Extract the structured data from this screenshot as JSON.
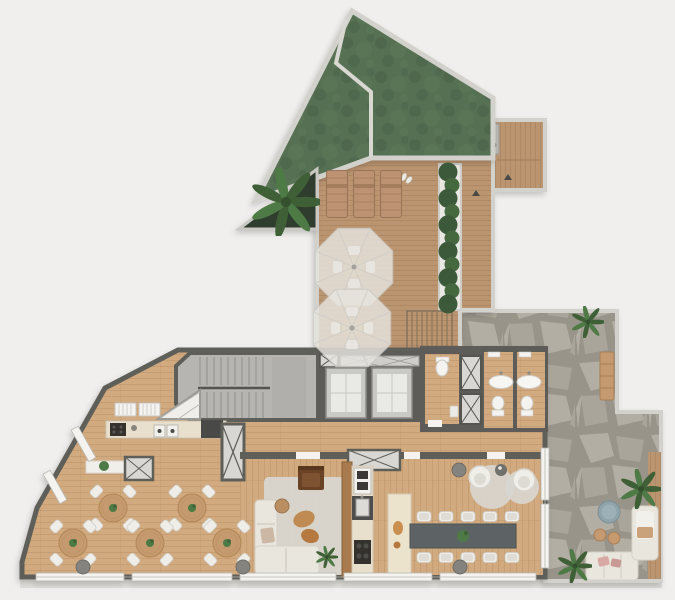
{
  "meta": {
    "name": "residential-rooftop-floor-plan",
    "description": "Top-down architectural floor plan rendering with green roof, sun deck, interior amenity floor and flagstone patio"
  },
  "colors": {
    "bg": "#f0efed",
    "wall_light": "#d2d1cc",
    "wall_mid": "#9a9a94",
    "wall_dark": "#5f5e5a",
    "roof_green": "#567052",
    "roof_green_dark": "#49614b",
    "roof_green_light": "#5e7a57",
    "planter_dark": "#2f3d2d",
    "deck": "#bb9570",
    "deck_line": "#a5805c",
    "floor": "#d2aa7f",
    "floor_line": "#bb9268",
    "stone_bg": "#98948a",
    "stone_fill": "#b2aea3",
    "stone_fill2": "#a9a59a",
    "stair": "#b6b5b1",
    "elevator_block": "#5d5c59",
    "cabin": "#c9c9c6",
    "counter": "#e8e0cd",
    "island": "#ece3cd",
    "hedge": "#3c5a39",
    "hedge2": "#46683f",
    "plant": "#4e7a46",
    "plant_dark": "#3f6036",
    "table_wood": "#c59a6f",
    "chair": "#efede8",
    "sofa": "#e9e6dd",
    "rug": "#d8d6d0",
    "armchair": "#6b4226",
    "coffee_table": "#c08b52",
    "long_table": "#5d6465",
    "partition": "#a97a4e",
    "umbrella": "#e7e5e0",
    "lounger": "#bc9273",
    "window": "#f4f3ef",
    "shaft": "#d8d7d3",
    "appliance_dark": "#34332f",
    "accent_pink": "#d8a9a4",
    "accent_blue": "#8fa3ab",
    "column": "#84837e"
  },
  "zones": {
    "green_roof": "green-roof",
    "roof_planter": "roof-planter-monstera",
    "sun_deck": "sun-deck",
    "lift_corridor": "accessible-lift-corridor",
    "hedge_planter": "hedge-planter",
    "deck_stairs": "deck-stairs",
    "stone_patio": "flagstone-patio",
    "stair_lobby": "stair-lobby",
    "elevators": "elevator-bank",
    "bathrooms": "bathrooms",
    "kitchen_west": "kitchen-west",
    "dining_area": "dining-area",
    "living_room": "living-room",
    "kitchen_east": "kitchen-east",
    "lounge_corner": "lounge-corner"
  },
  "furniture": {
    "loungers": [
      {
        "x": 326,
        "y": 170
      },
      {
        "x": 353,
        "y": 170
      },
      {
        "x": 380,
        "y": 170
      }
    ],
    "umbrellas": [
      {
        "cx": 354,
        "cy": 267
      },
      {
        "cx": 352,
        "cy": 328
      }
    ],
    "dining_tables": [
      {
        "cx": 113,
        "cy": 508
      },
      {
        "cx": 192,
        "cy": 508
      },
      {
        "cx": 73,
        "cy": 543
      },
      {
        "cx": 150,
        "cy": 543
      },
      {
        "cx": 227,
        "cy": 543
      }
    ],
    "long_table_chairs": {
      "xs": [
        424,
        446,
        468,
        490,
        512
      ],
      "top_y": 511,
      "bottom_y": 552
    },
    "columns": [
      {
        "cx": 83,
        "cy": 567
      },
      {
        "cx": 243,
        "cy": 567
      },
      {
        "cx": 459,
        "cy": 470
      },
      {
        "cx": 460,
        "cy": 567
      }
    ],
    "palms": [
      {
        "cx": 641,
        "cy": 489,
        "s": 1.0
      },
      {
        "cx": 575,
        "cy": 566,
        "s": 0.85
      },
      {
        "cx": 588,
        "cy": 322,
        "s": 0.8
      },
      {
        "cx": 286,
        "cy": 202,
        "s": 1.7
      },
      {
        "cx": 327,
        "cy": 557,
        "s": 0.55
      }
    ],
    "hedge": {
      "cx": 450,
      "y_start": 172,
      "y_end": 304,
      "count": 11
    }
  }
}
